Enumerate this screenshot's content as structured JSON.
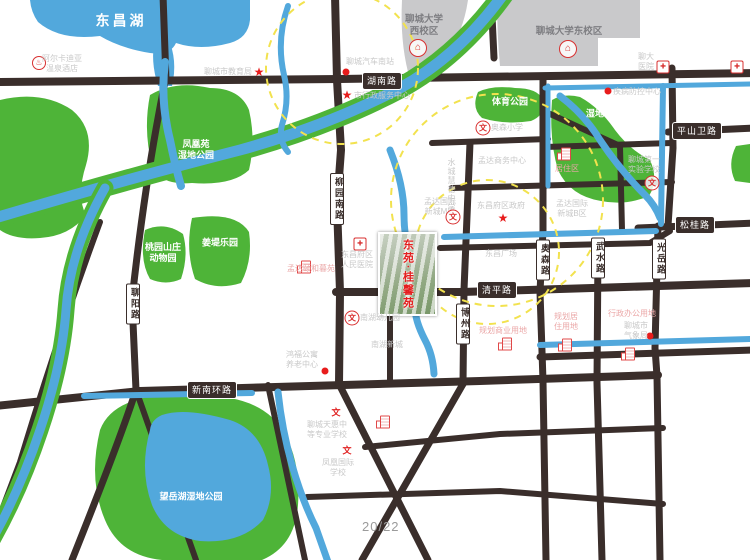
{
  "watermark": "20/22",
  "project_photo": {
    "name": "东苑·桂馨苑",
    "x": 378,
    "y": 232,
    "w": 55,
    "h": 80
  },
  "colors": {
    "road": "#3a2e2b",
    "water": "#52a8dc",
    "park_green": "#4eb438",
    "campus_gray": "#c9c9cb",
    "poi_red": "#e81c1c",
    "radius_ring_yellow": "#f2e24e"
  },
  "icon_glyphs": {
    "star": "★",
    "dot": "",
    "hospital": "✚",
    "wen": "文",
    "wen-plain": "文",
    "school": "⌂",
    "hotel": "♨",
    "bldg": ""
  },
  "road_labels_horizontal": [
    {
      "text": "湖南路",
      "x": 382,
      "y": 81
    },
    {
      "text": "平山卫路",
      "x": 697,
      "y": 131
    },
    {
      "text": "松桂路",
      "x": 695,
      "y": 225
    },
    {
      "text": "清平路",
      "x": 497,
      "y": 290
    },
    {
      "text": "新南环路",
      "x": 212,
      "y": 390
    }
  ],
  "road_labels_vertical": [
    {
      "text": "柳园南路",
      "x": 337,
      "y": 199
    },
    {
      "text": "聊阳路",
      "x": 133,
      "y": 304
    },
    {
      "text": "博州路",
      "x": 463,
      "y": 324
    },
    {
      "text": "奥森路",
      "x": 543,
      "y": 260
    },
    {
      "text": "武水路",
      "x": 598,
      "y": 258
    },
    {
      "text": "光岳路",
      "x": 659,
      "y": 259
    }
  ],
  "area_labels": [
    {
      "text": "东昌湖",
      "x": 121,
      "y": 21,
      "cls": "lake-big"
    },
    {
      "text": "凤凰苑\n湿地公园",
      "x": 196,
      "y": 150,
      "cls": "park"
    },
    {
      "text": "桃园山庄\n动物园",
      "x": 163,
      "y": 253,
      "cls": "park"
    },
    {
      "text": "姜堤乐园",
      "x": 220,
      "y": 243,
      "cls": "park"
    },
    {
      "text": "体育公园",
      "x": 510,
      "y": 102,
      "cls": "park"
    },
    {
      "text": "湿地公园",
      "x": 604,
      "y": 114,
      "cls": "park"
    },
    {
      "text": "望岳湖湿地公园",
      "x": 191,
      "y": 497,
      "cls": "park"
    },
    {
      "text": "聊城大学\n西校区",
      "x": 424,
      "y": 26,
      "cls": "campus"
    },
    {
      "text": "聊城大学东校区",
      "x": 569,
      "y": 32,
      "cls": "campus"
    },
    {
      "text": "水城慧德中学",
      "x": 451,
      "y": 185,
      "cls": "faint-v"
    },
    {
      "text": "孟达国际\n新城M区",
      "x": 440,
      "y": 207,
      "cls": "faint"
    },
    {
      "text": "孟达国际\n新城B区",
      "x": 572,
      "y": 209,
      "cls": "faint"
    },
    {
      "text": "孟达商务中心",
      "x": 502,
      "y": 161,
      "cls": "faint"
    },
    {
      "text": "东昌广场",
      "x": 501,
      "y": 254,
      "cls": "faint"
    }
  ],
  "pois": [
    {
      "type": "hotel",
      "ix": 39,
      "iy": 63,
      "text": "阿尔卡迪亚\n温泉酒店",
      "lx": 62,
      "ly": 64,
      "cls": "faint"
    },
    {
      "type": "star",
      "ix": 259,
      "iy": 72,
      "text": "聊城市教育局",
      "lx": 228,
      "ly": 72,
      "cls": "faint"
    },
    {
      "type": "dot",
      "ix": 346,
      "iy": 72,
      "text": "聊城汽车南站",
      "lx": 370,
      "ly": 62,
      "cls": "faint"
    },
    {
      "type": "star",
      "ix": 347,
      "iy": 95,
      "text": "市行政服务中心",
      "lx": 382,
      "ly": 96,
      "cls": "faint"
    },
    {
      "type": "school",
      "ix": 418,
      "iy": 48,
      "text": "",
      "lx": 0,
      "ly": 0,
      "cls": "faint"
    },
    {
      "type": "school",
      "ix": 568,
      "iy": 49,
      "text": "",
      "lx": 0,
      "ly": 0,
      "cls": "faint"
    },
    {
      "type": "hospital",
      "ix": 663,
      "iy": 67,
      "text": "聊大\n医院",
      "lx": 646,
      "ly": 62,
      "cls": "faint"
    },
    {
      "type": "hospital",
      "ix": 737,
      "iy": 67,
      "text": "",
      "lx": 0,
      "ly": 0,
      "cls": "faint"
    },
    {
      "type": "dot",
      "ix": 608,
      "iy": 91,
      "text": "疾病防控中心",
      "lx": 637,
      "ly": 92,
      "cls": "faint"
    },
    {
      "type": "wen",
      "ix": 483,
      "iy": 128,
      "text": "奥森小学",
      "lx": 507,
      "ly": 128,
      "cls": "faint"
    },
    {
      "type": "wen",
      "ix": 652,
      "iy": 183,
      "text": "聊城第一\n实验学校",
      "lx": 644,
      "ly": 165,
      "cls": "faint"
    },
    {
      "type": "bldg",
      "ix": 566,
      "iy": 154,
      "text": "居住区",
      "lx": 567,
      "ly": 169,
      "cls": "pink"
    },
    {
      "type": "star",
      "ix": 503,
      "iy": 218,
      "text": "东昌府区政府",
      "lx": 501,
      "ly": 206,
      "cls": "faint"
    },
    {
      "type": "wen",
      "ix": 453,
      "iy": 217,
      "text": "",
      "lx": 0,
      "ly": 0,
      "cls": "faint"
    },
    {
      "type": "hospital",
      "ix": 360,
      "iy": 244,
      "text": "东昌府区\n人民医院",
      "lx": 357,
      "ly": 260,
      "cls": "faint"
    },
    {
      "type": "bldg",
      "ix": 306,
      "iy": 254,
      "text": "孟达颐和暮苑",
      "lx": 311,
      "ly": 269,
      "cls": "pink"
    },
    {
      "type": "bldg",
      "ix": 507,
      "iy": 318,
      "text": "规划商业用地",
      "lx": 503,
      "ly": 331,
      "cls": "pink"
    },
    {
      "type": "bldg",
      "ix": 567,
      "iy": 306,
      "text": "规划居\n住用地",
      "lx": 566,
      "ly": 322,
      "cls": "pink"
    },
    {
      "type": "bldg",
      "ix": 630,
      "iy": 302,
      "text": "行政办公用地",
      "lx": 632,
      "ly": 314,
      "cls": "pink"
    },
    {
      "type": "dot",
      "ix": 650,
      "iy": 336,
      "text": "聊城市\n气象局",
      "lx": 636,
      "ly": 331,
      "cls": "faint"
    },
    {
      "type": "dot",
      "ix": 325,
      "iy": 371,
      "text": "鸿福公寓\n养老中心",
      "lx": 302,
      "ly": 360,
      "cls": "faint"
    },
    {
      "type": "wen",
      "ix": 352,
      "iy": 318,
      "text": "南湖幼儿园",
      "lx": 380,
      "ly": 318,
      "cls": "faint"
    },
    {
      "type": "bldg",
      "ix": 385,
      "iy": 357,
      "text": "南湖新城",
      "lx": 387,
      "ly": 345,
      "cls": "faint"
    },
    {
      "type": "wen-plain",
      "ix": 336,
      "iy": 413,
      "text": "聊城天惠中\n等专业学校",
      "lx": 327,
      "ly": 430,
      "cls": "faint"
    },
    {
      "type": "wen-plain",
      "ix": 347,
      "iy": 451,
      "text": "凤凰国际\n学校",
      "lx": 338,
      "ly": 468,
      "cls": "faint"
    }
  ]
}
